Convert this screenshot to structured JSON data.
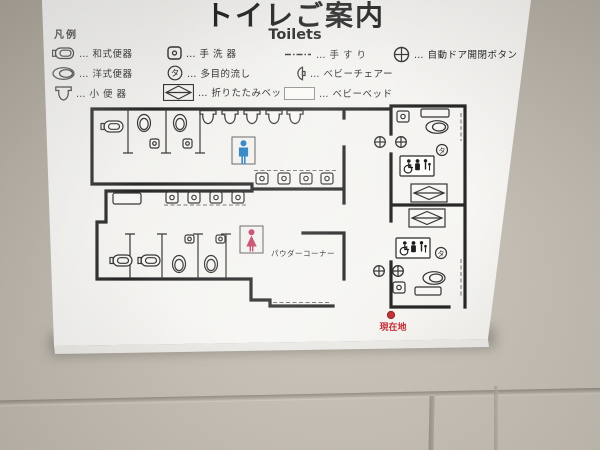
{
  "sign": {
    "title": "トイレご案内",
    "subtitle": "Toilets",
    "legend_heading": "凡例",
    "legend": [
      {
        "icon": "squat-toilet-icon",
        "label": "… 和式便器"
      },
      {
        "icon": "western-toilet-icon",
        "label": "… 洋式便器"
      },
      {
        "icon": "urinal-icon",
        "label": "… 小 便 器"
      },
      {
        "icon": "hand-wash-basin-icon",
        "label": "… 手 洗 器"
      },
      {
        "icon": "multipurpose-sink-icon",
        "label": "… 多目的流し"
      },
      {
        "icon": "folding-bed-icon",
        "label": "… 折りたたみベッド"
      },
      {
        "icon": "handrail-icon",
        "label": "… 手 す り"
      },
      {
        "icon": "baby-chair-icon",
        "label": "… ベビーチェアー"
      },
      {
        "icon": "baby-bed-icon",
        "label": "… ベビーベッド"
      },
      {
        "icon": "auto-door-button-icon",
        "label": "… 自動ドア開閉ボタン"
      }
    ],
    "map": {
      "powder_corner_label": "パウダーコーナー",
      "current_location_label": "現在地",
      "multipurpose_sink_char": "タ"
    },
    "colors": {
      "male_pictogram": "#1b79bd",
      "female_pictogram": "#c23a5f",
      "current_location_red": "#c0272d",
      "wall_line": "#1d1d1d"
    }
  }
}
